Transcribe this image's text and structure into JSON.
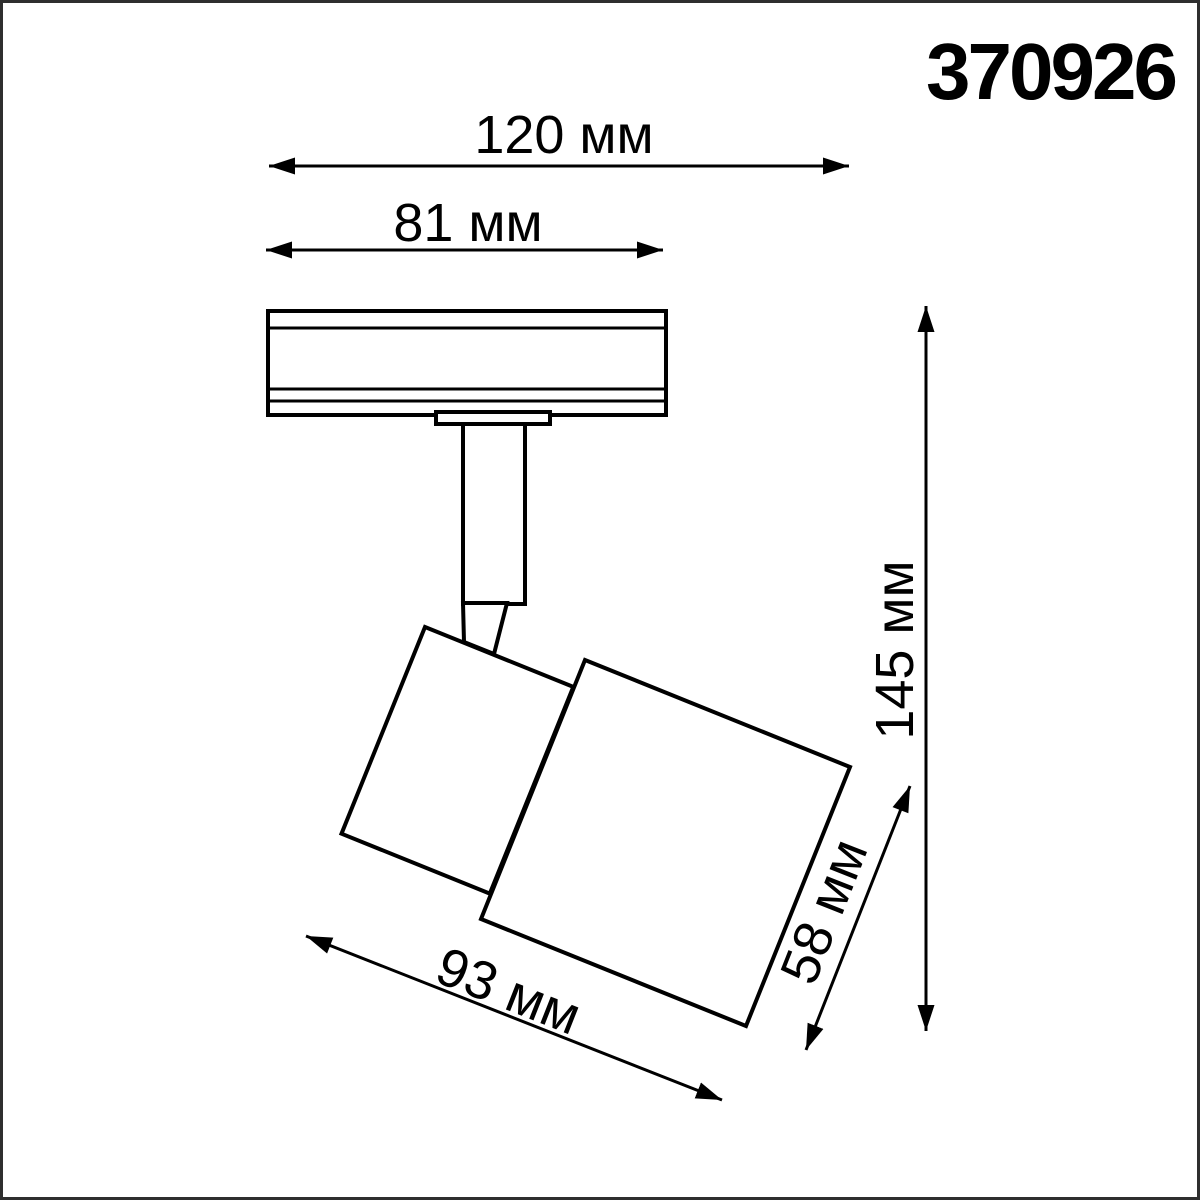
{
  "page": {
    "product_code": "370926"
  },
  "dims": {
    "d120": {
      "label": "120 мм",
      "value_mm": 120
    },
    "d81": {
      "label": "81 мм",
      "value_mm": 81
    },
    "d145": {
      "label": "145 мм",
      "value_mm": 145
    },
    "d58": {
      "label": "58 мм",
      "value_mm": 58
    },
    "d93": {
      "label": "93 мм",
      "value_mm": 93
    }
  },
  "colors": {
    "line": "#000000",
    "frame": "#2f2f2f",
    "background": "#ffffff"
  }
}
